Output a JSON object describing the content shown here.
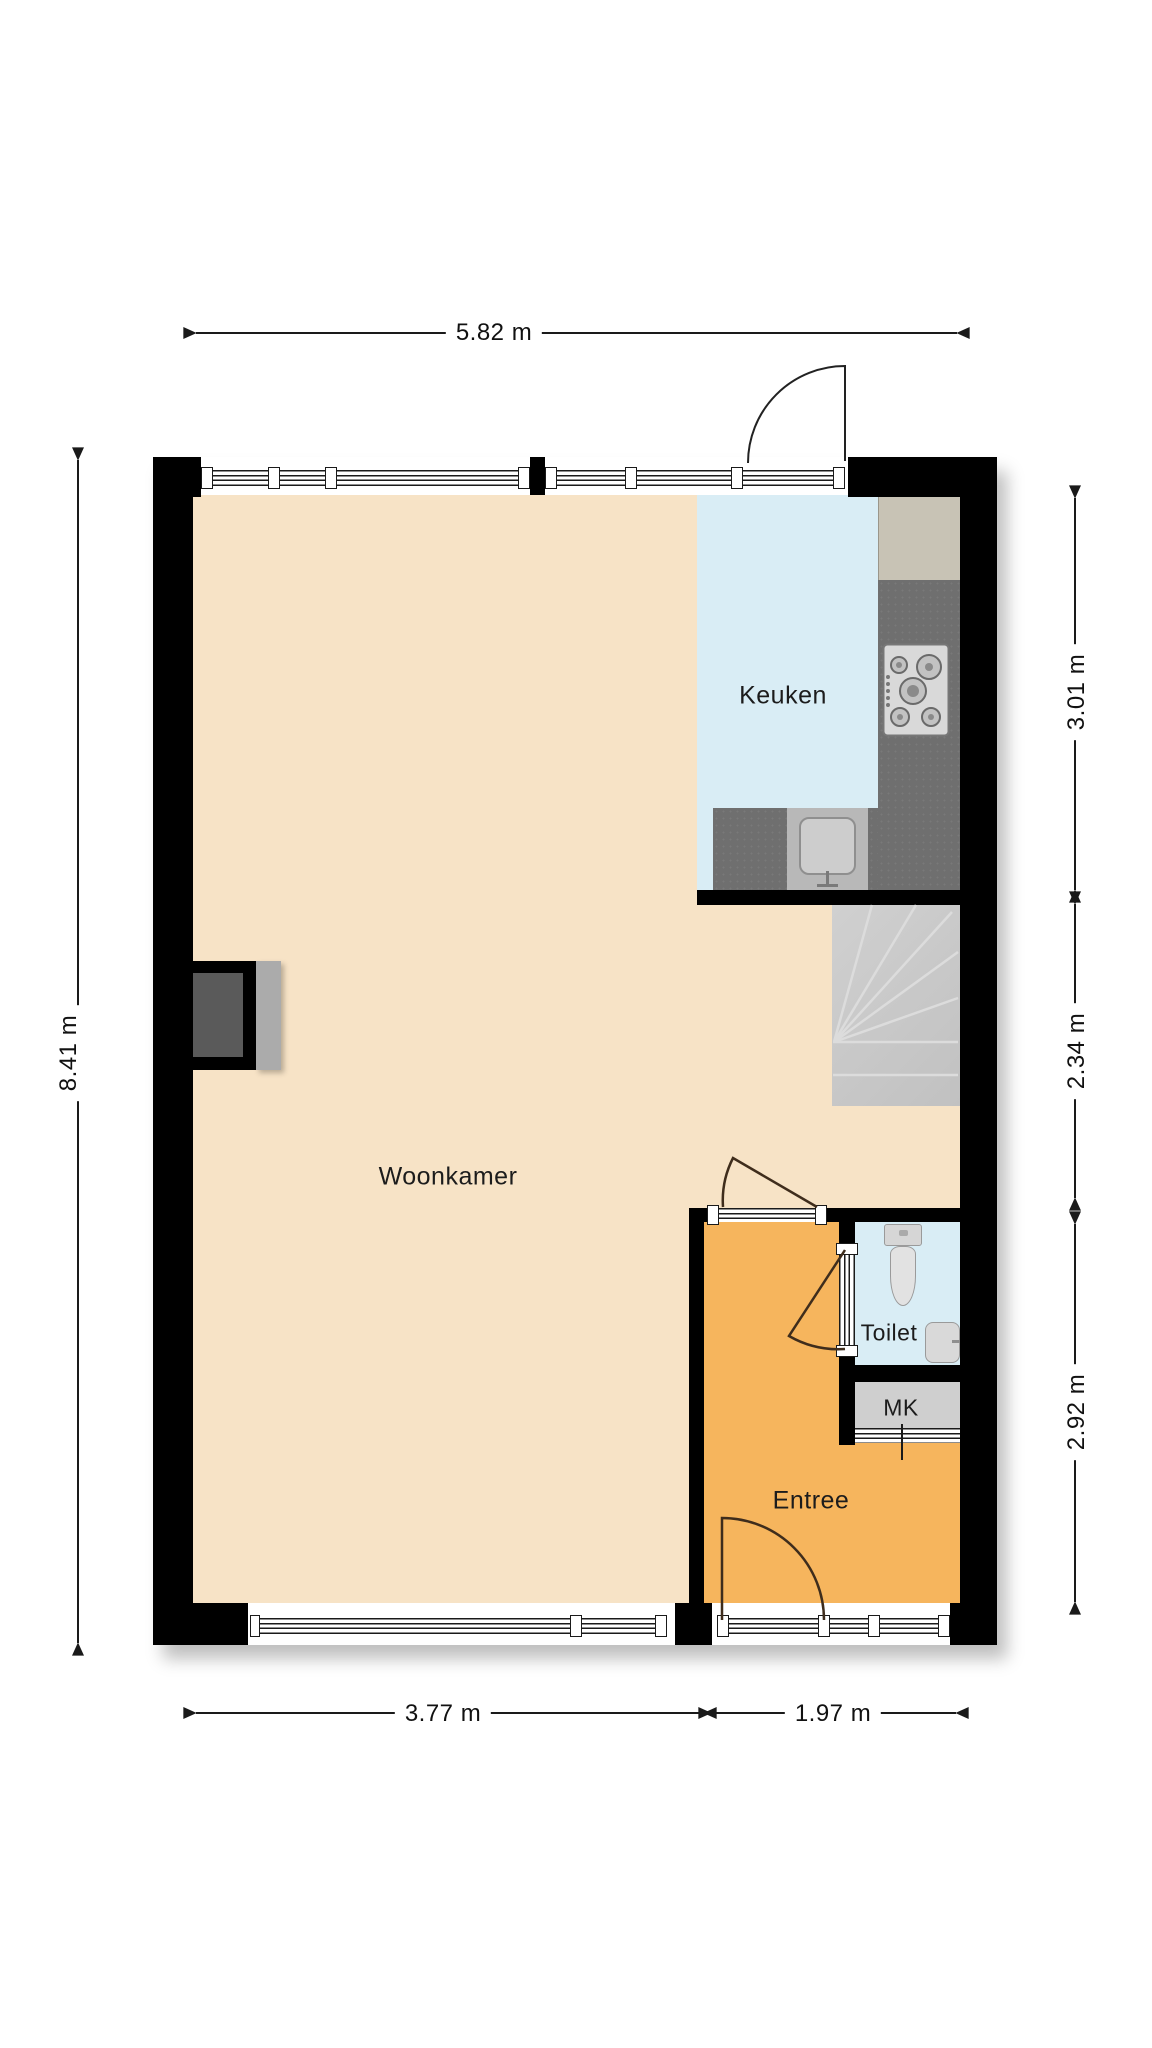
{
  "plan": {
    "type": "floorplan",
    "unit": "m"
  },
  "rooms": {
    "woonkamer": {
      "label": "Woonkamer",
      "floor_color": "#f7e3c6"
    },
    "keuken": {
      "label": "Keuken",
      "floor_color": "#d9edf5"
    },
    "toilet": {
      "label": "Toilet",
      "floor_color": "#d9edf5"
    },
    "mk": {
      "label": "MK",
      "floor_color": "#cfcfcf"
    },
    "entree": {
      "label": "Entree",
      "floor_color": "#f6b55d"
    }
  },
  "dimensions": {
    "top_width": {
      "label": "5.82 m",
      "value_m": 5.82,
      "side": "top"
    },
    "left_height": {
      "label": "8.41 m",
      "value_m": 8.41,
      "side": "left"
    },
    "right_kitchen": {
      "label": "3.01 m",
      "value_m": 3.01,
      "side": "right"
    },
    "right_stairs": {
      "label": "2.34 m",
      "value_m": 2.34,
      "side": "right"
    },
    "right_entree": {
      "label": "2.92 m",
      "value_m": 2.92,
      "side": "right"
    },
    "bottom_livingroom": {
      "label": "3.77 m",
      "value_m": 3.77,
      "side": "bottom"
    },
    "bottom_entree": {
      "label": "1.97 m",
      "value_m": 1.97,
      "side": "bottom"
    }
  },
  "fixtures": [
    "staircase",
    "gas-hob",
    "kitchen-sink",
    "kitchen-counter",
    "tall-cabinet",
    "fireplace",
    "toilet-bowl",
    "washbasin",
    "front-door",
    "back-door",
    "interior-door",
    "toilet-door",
    "mk-door"
  ],
  "palette": {
    "wall": "#000000",
    "counter_dark": "#6f6f6f",
    "counter_light": "#b8b8b8",
    "cabinet": "#c8c3b5",
    "stairs": "#c7c7c7",
    "fixture_light": "#dedede",
    "dimension_text": "#111111"
  }
}
